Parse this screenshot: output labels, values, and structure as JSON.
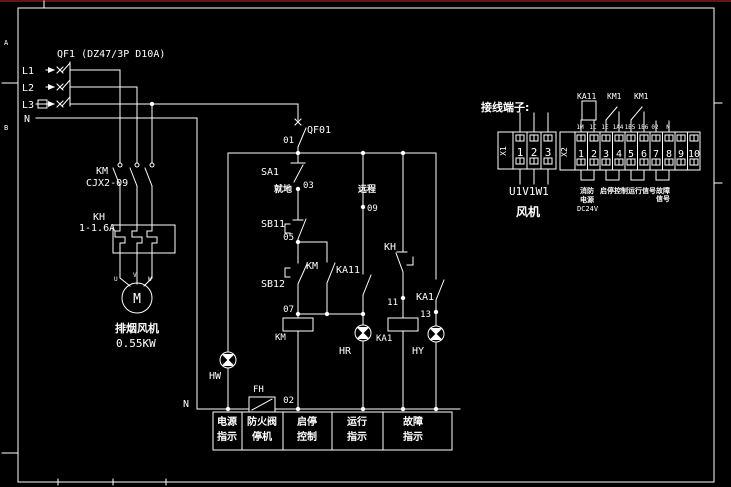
{
  "zones": {
    "a": "A",
    "b": "B"
  },
  "power": {
    "breaker": "QF1 (DZ47/3P D10A)",
    "l1": "L1",
    "l2": "L2",
    "l3": "L3",
    "n": "N",
    "km": "KM",
    "km_model": "CJX2-09",
    "kh": "KH",
    "kh_range": "1-1.6A",
    "motor_m": "M",
    "t_u": "U",
    "t_v": "V",
    "t_w": "W",
    "motor_name": "排烟风机",
    "motor_power": "0.55KW"
  },
  "control": {
    "qf01": "QF01",
    "n01": "01",
    "n02": "02",
    "n03": "03",
    "n05": "05",
    "n07": "07",
    "n09": "09",
    "n11": "11",
    "n13": "13",
    "sa1": "SA1",
    "sa1_local": "就地",
    "sa1_remote": "远程",
    "sb11": "SB11",
    "sb12": "SB12",
    "km_aux": "KM",
    "ka11_aux": "KA11",
    "km_coil": "KM",
    "kh_aux": "KH",
    "ka1_coil": "KA1",
    "ka1_aux": "KA1",
    "hw": "HW",
    "hr": "HR",
    "hy": "HY",
    "fh": "FH",
    "n_label": "N"
  },
  "legend": {
    "c1a": "电源",
    "c1b": "指示",
    "c2a": "防火阀",
    "c2b": "停机",
    "c3a": "启停",
    "c3b": "控制",
    "c4a": "运行",
    "c4b": "指示",
    "c5a": "故障",
    "c5b": "指示"
  },
  "terminals": {
    "title": "接线端子:",
    "x1": "X1",
    "x1n1": "1",
    "x1n2": "2",
    "x1n3": "3",
    "x1_wires": "U1V1W1",
    "x1_caption": "风机",
    "x2": "X2",
    "x2n": [
      "1",
      "2",
      "3",
      "4",
      "5",
      "6",
      "7",
      "8",
      "9",
      "10"
    ],
    "dev1": "KA11",
    "dev2": "KM1",
    "dev3": "KM1",
    "tags": [
      "1M",
      "1C",
      "1E",
      "1A4",
      "1B5",
      "1B6",
      "02",
      "N"
    ],
    "g1a": "消防",
    "g1b": "电源",
    "g1c": "DC24V",
    "g2": "启停控制",
    "g3": "运行信号",
    "g4a": "故障",
    "g4b": "信号"
  }
}
